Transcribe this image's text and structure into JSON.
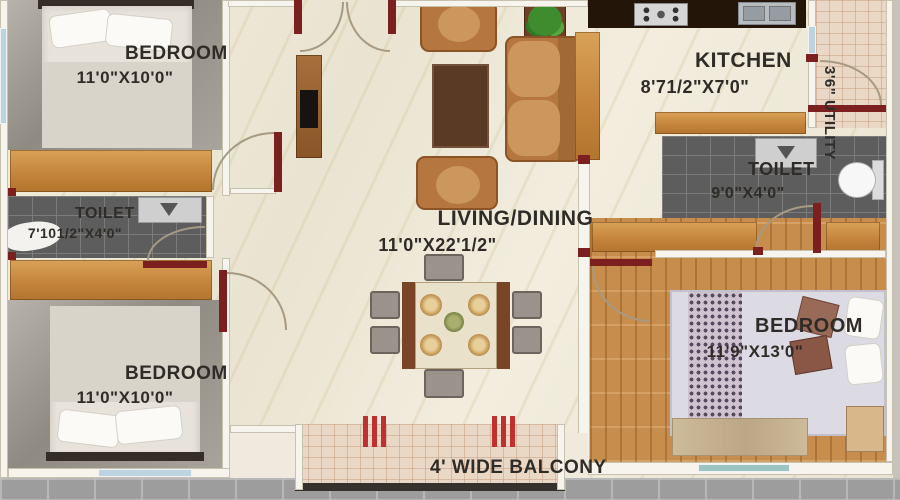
{
  "rooms": {
    "bedroom_top_left": {
      "name": "BEDROOM",
      "dims": "11'0\"X10'0\""
    },
    "toilet_left": {
      "name": "TOILET",
      "dims": "7'101/2\"X4'0\""
    },
    "bedroom_bottom_left": {
      "name": "BEDROOM",
      "dims": "11'0\"X10'0\""
    },
    "living_dining": {
      "name": "LIVING/DINING",
      "dims": "11'0\"X22'1/2\""
    },
    "kitchen": {
      "name": "KITCHEN",
      "dims": "8'71/2\"X7'0\""
    },
    "utility": {
      "name": "3'6\" UTILITY"
    },
    "toilet_right": {
      "name": "TOILET",
      "dims": "9'0\"X4'0\""
    },
    "bedroom_right": {
      "name": "BEDROOM",
      "dims": "11'9\"X13'0\""
    },
    "balcony": {
      "name": "4' WIDE BALCONY"
    }
  },
  "colors": {
    "wall_accent": "#7c1f1f",
    "floor_marble": "#ece7d6",
    "wood": "#c98e4d",
    "kitchen_counter_dark": "#241509",
    "toilet_tile_dark": "#5d5d5d",
    "tile_pink": "#ead8c6",
    "window_blue": "#bcd4e2",
    "balcony_marker_red": "#c03030",
    "label_text": "#2f2c28"
  }
}
